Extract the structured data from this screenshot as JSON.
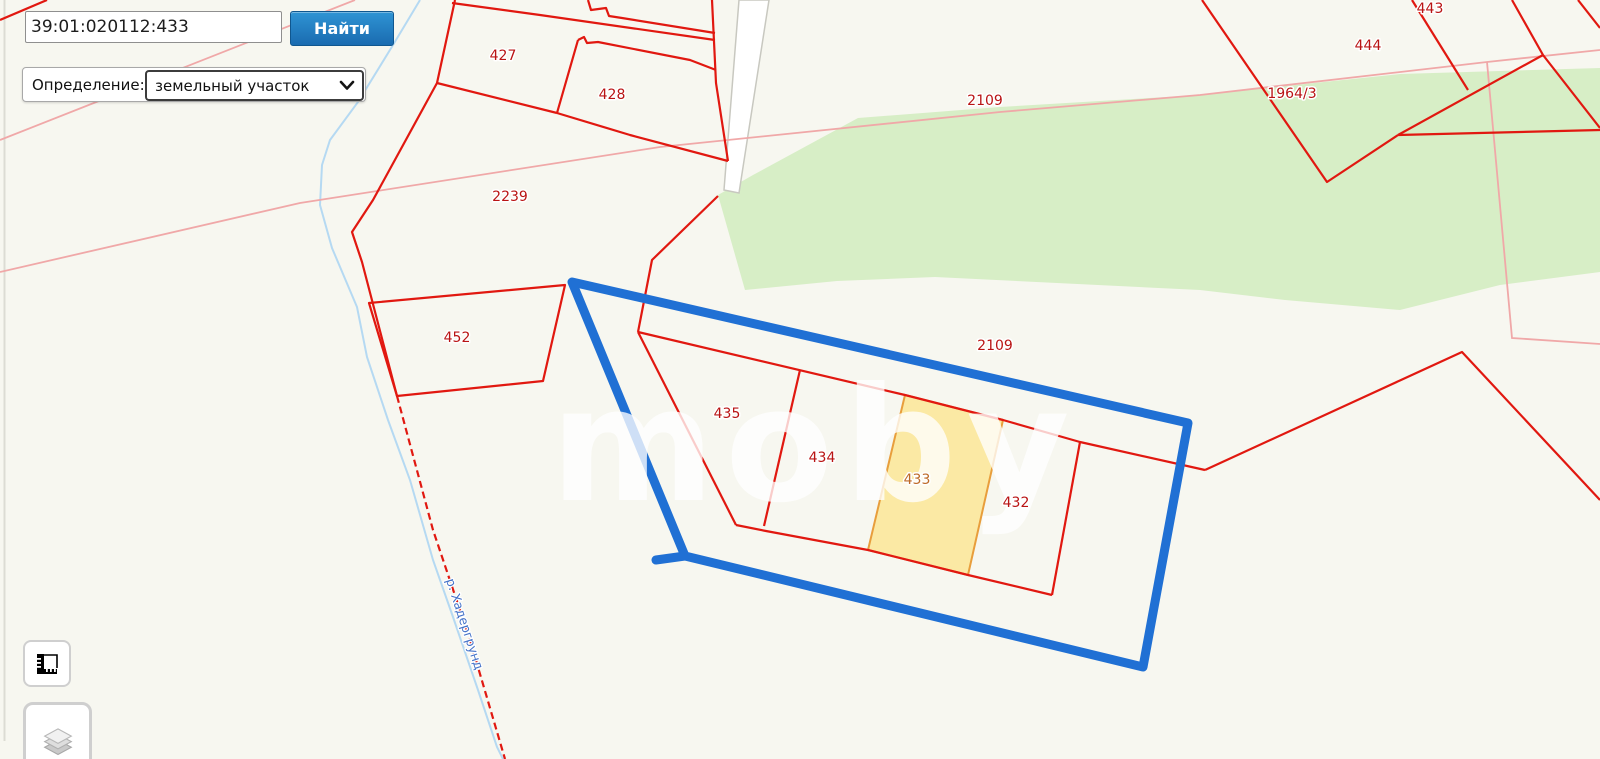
{
  "search": {
    "value": "39:01:020112:433",
    "button_label": "Найти"
  },
  "filter": {
    "label": "Определение:",
    "value": "земельный участок",
    "chevron_icon": "chevron-down-icon"
  },
  "map": {
    "watermark": "moby",
    "river_label": "р. Хадергрунд",
    "selected_parcel": "433",
    "labels": [
      {
        "text": "427"
      },
      {
        "text": "428"
      },
      {
        "text": "2239"
      },
      {
        "text": "452"
      },
      {
        "text": "435"
      },
      {
        "text": "434"
      },
      {
        "text": "433"
      },
      {
        "text": "432"
      },
      {
        "text": "2109"
      },
      {
        "text": "2109"
      },
      {
        "text": "443"
      },
      {
        "text": "444"
      },
      {
        "text": "1964/3"
      }
    ],
    "colors": {
      "background": "#F7F7F0",
      "vegetation": "#D7EEC6",
      "water": "#B5D9F2",
      "parcel_line": "#E11810",
      "zone_line_soft": "#F0A8A8",
      "selection_outline": "#2070D4",
      "highlight_fill": "#FBE9A4",
      "highlight_stroke": "#E89E3C",
      "label_red": "#B91414",
      "label_highlight": "#BE6A28",
      "river_label_color": "#4472C8",
      "button_blue": "#1a6bb0"
    }
  },
  "controls": {
    "measure_icon": "ruler-icon",
    "layers_icon": "layers-icon"
  }
}
